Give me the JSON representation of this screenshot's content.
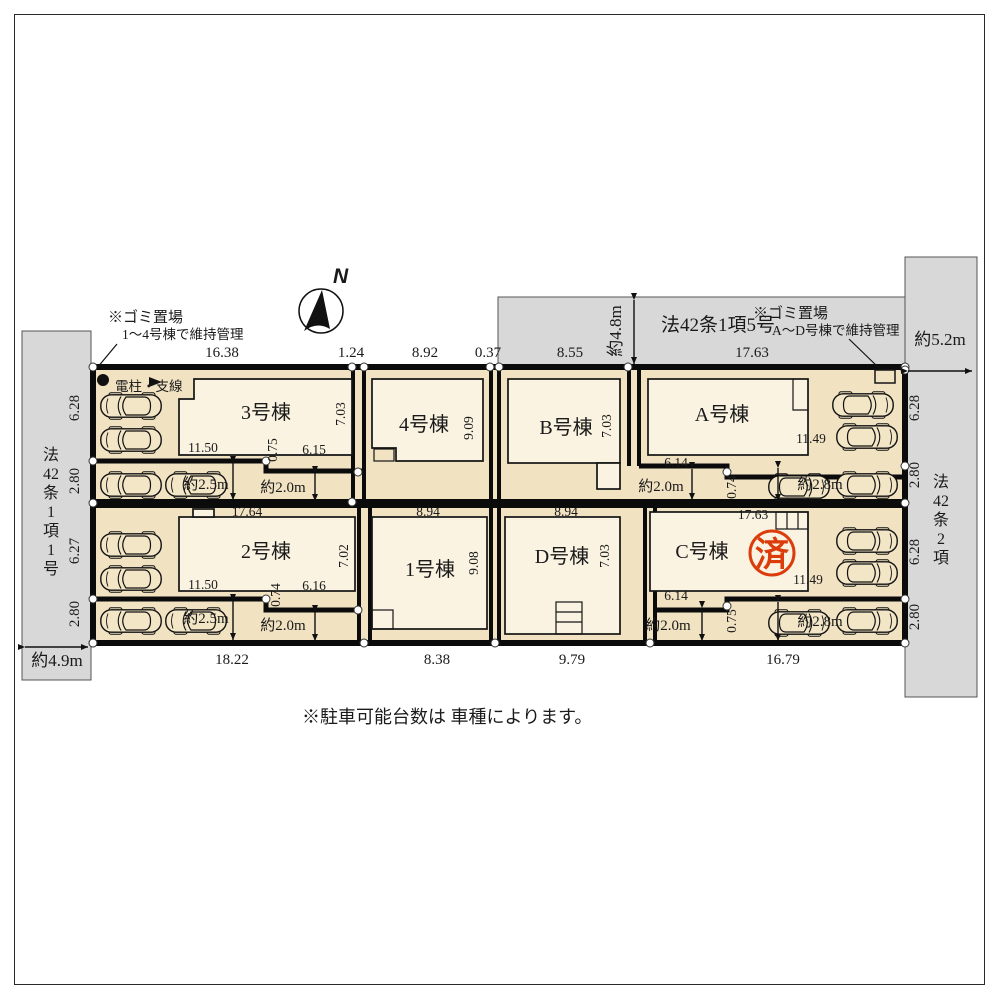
{
  "compass": {
    "label": "N"
  },
  "roads": {
    "top": {
      "name": "法42条1項5号",
      "width": "約4.8m"
    },
    "left": {
      "name": "法42条1項1号",
      "name_chars": [
        "法",
        "42",
        "条",
        "1",
        "項",
        "1",
        "号"
      ],
      "width": "約4.9m"
    },
    "right": {
      "name": "法42条2項",
      "name_chars": [
        "法",
        "42",
        "条",
        "2",
        "項"
      ],
      "width": "約5.2m"
    }
  },
  "garbage_notes": {
    "west": {
      "line1": "※ゴミ置場",
      "line2": "1～4号棟で維持管理"
    },
    "east": {
      "line1": "※ゴミ置場",
      "line2": "A～D号棟で維持管理"
    }
  },
  "utility_pole_label": "電柱・支線",
  "parking_note": "※駐車可能台数は 車種によります。",
  "sold_stamp": "済",
  "boundary_dims": {
    "top": [
      "16.38",
      "1.24",
      "8.92",
      "0.37",
      "8.55",
      "17.63"
    ],
    "bottom": [
      "18.22",
      "8.38",
      "9.79",
      "16.79"
    ],
    "left": [
      "6.28",
      "2.80",
      "6.27",
      "2.80"
    ],
    "right": [
      "6.28",
      "2.80",
      "6.28",
      "2.80"
    ]
  },
  "buildings": {
    "b3": {
      "label": "3号棟",
      "right": "7.03",
      "bottom_left": "11.50",
      "step": "0.75",
      "bottom_right": "6.15"
    },
    "b4": {
      "label": "4号棟",
      "right": "9.09"
    },
    "bB": {
      "label": "B号棟",
      "right": "7.03"
    },
    "bA": {
      "label": "A号棟",
      "bottom_left": "6.14",
      "bottom_right": "11.49",
      "step": "0.74"
    },
    "b2": {
      "label": "2号棟",
      "top": "17.64",
      "right": "7.02",
      "bottom_left": "11.50",
      "step": "0.74",
      "bottom_right": "6.16"
    },
    "b1": {
      "label": "1号棟",
      "top": "8.94",
      "right": "9.08"
    },
    "bD": {
      "label": "D号棟",
      "top": "8.94",
      "right": "7.03"
    },
    "bC": {
      "label": "C号棟",
      "top": "17.63",
      "bottom_left": "6.14",
      "bottom_right": "11.49",
      "step": "0.75"
    }
  },
  "driveways": {
    "nw": {
      "w1": "約2.5m",
      "w2": "約2.0m"
    },
    "ne": {
      "w1": "約2.0m",
      "w2": "約2.8m"
    },
    "sw": {
      "w1": "約2.5m",
      "w2": "約2.0m"
    },
    "se": {
      "w1": "約2.0m",
      "w2": "約2.8m"
    }
  },
  "colors": {
    "lot": "#f1e2c2",
    "building": "#faf3e1",
    "road": "#d8d8d8",
    "stamp": "#dc3b0b"
  }
}
